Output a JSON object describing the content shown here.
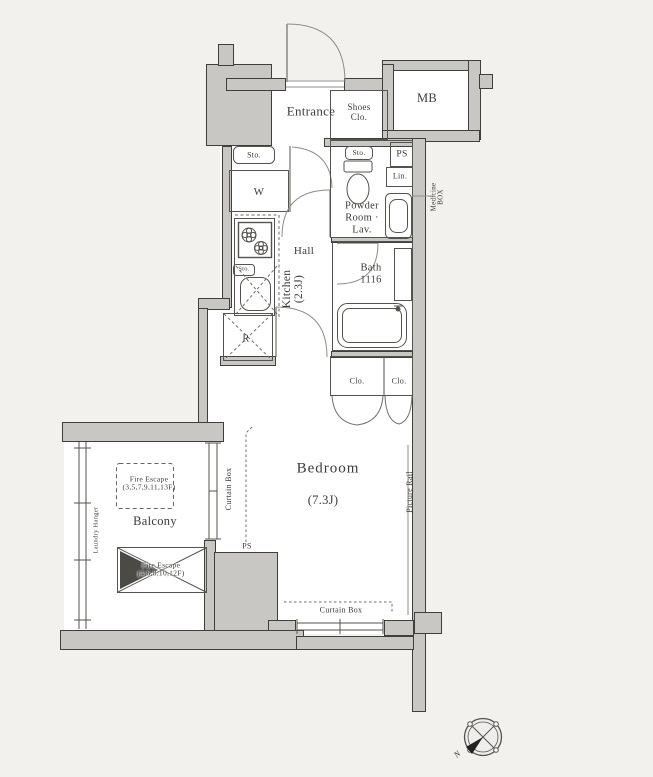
{
  "meta": {
    "type": "apartment-floor-plan"
  },
  "rooms": {
    "entrance": "Entrance",
    "shoes_clo": "Shoes\nClo.",
    "mb": "MB",
    "washer": "W",
    "hall": "Hall",
    "kitchen": "Kitchen\n(2.3J)",
    "powder": "Powder\nRoom ·\nLav.",
    "bath": "Bath\n1116",
    "bedroom_name": "Bedroom",
    "bedroom_size": "(7.3J)",
    "balcony": "Balcony"
  },
  "fixtures": {
    "sto_entrance": "Sto.",
    "sto_powder": "Sto.",
    "sto_kitchen": "Sto.",
    "ps_shaft": "PS",
    "ps_bedroom": "PS",
    "linen": "Lin.",
    "medicine_box": "Medicine\nBOX",
    "closet_left": "Clo.",
    "closet_right": "Clo.",
    "refrigerator": "R"
  },
  "annotations": {
    "curtain_box_left": "Curtain Box",
    "curtain_box_bottom": "Curtain Box",
    "picture_rail": "Picture Rail",
    "laundry_hanger": "Laundry Hanger",
    "fire_escape_upper": "Fire Escape\n(3,5,7,9,11,13F)",
    "fire_escape_lower": "Fire Escape\n(4,6,8,10,12F)",
    "compass_north": "N"
  },
  "colors": {
    "background": "#f2f1ee",
    "floor": "#ffffff",
    "wall_fill": "#c8c7c4",
    "wall_line": "#403f3c",
    "text": "#3c3b38"
  }
}
